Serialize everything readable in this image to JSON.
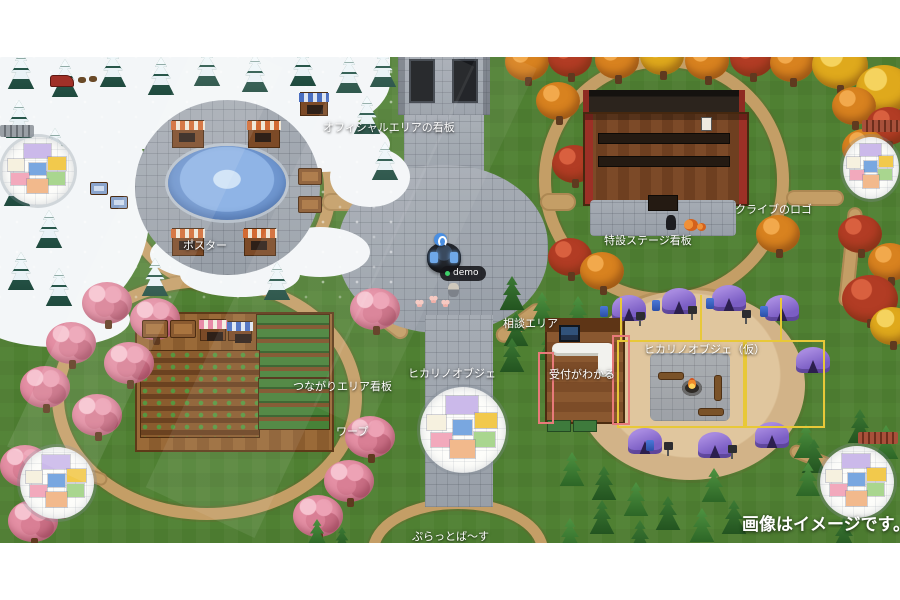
{
  "scene": {
    "disclaimer": "画像はイメージです。",
    "avatar": {
      "name": "demo",
      "status_icon": "online-dot",
      "badge_icon": "pin-badge-icon"
    },
    "labels": {
      "official_sign": "オフィシャルエリアの看板",
      "poster": "ポスター",
      "stage_sign": "特設ステージ看板",
      "logo": "クライブのロゴ",
      "tsunagari_sign": "つながりエリア看板",
      "warp": "ワープ",
      "hikari_object": "ヒカリノオブジェ",
      "hikari_object_temp": "ヒカリノオブジェ（仮）",
      "consult_area": "相談エリア",
      "reception": "受付がわかる",
      "platverse": "ぷらっとば〜す"
    },
    "colors": {
      "grass": "#4f8032",
      "snow": "#f3f6f8",
      "stone": "#9ba1a9",
      "dirt_path": "#c49e66",
      "campsite_dirt": "#d9bd93",
      "tent_purple": "#8d72cc",
      "cherry_pink": "#e48fa4",
      "autumn_orange": "#d8821f",
      "autumn_yellow": "#dfa91c",
      "autumn_red": "#b23c24",
      "pine_green": "#3c7a34",
      "highlight_yellow": "#e8c838",
      "highlight_red": "#e87a7a"
    },
    "warp_pad_cell_colors": [
      "#cbb9ea",
      "#f6f1df",
      "#f2c94c",
      "#79a7e0",
      "#f2a9bc",
      "#a9d68f",
      "#f2b98c"
    ]
  }
}
